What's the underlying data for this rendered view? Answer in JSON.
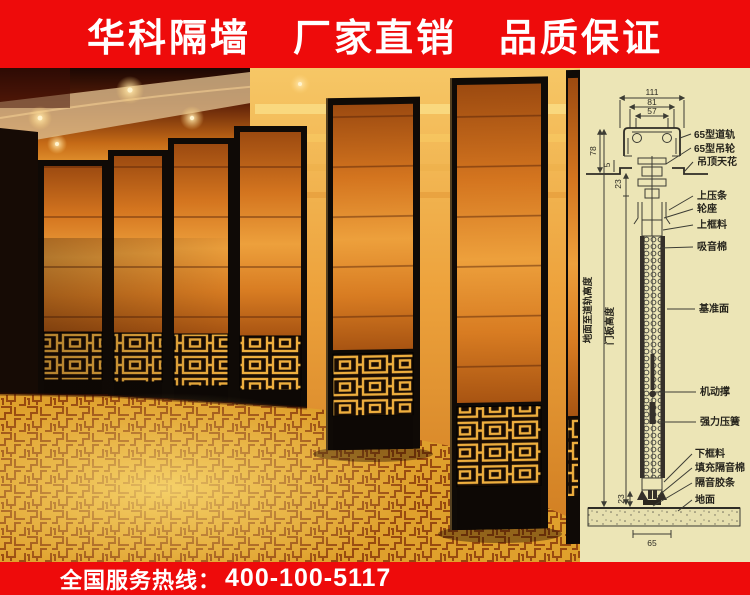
{
  "top_banner": {
    "segments": [
      "华科隔墙",
      "厂家直销",
      "品质保证"
    ]
  },
  "bottom_banner": {
    "hotline_label": "全国服务热线：",
    "phone": "400-100-5117"
  },
  "colors": {
    "banner_red": "#ee0b0b",
    "diagram_background": "#ece5b6",
    "photo_gold": "#dfa02c"
  },
  "diagram": {
    "dimensions": {
      "top_width": "111",
      "mid_width": "81",
      "inner_width": "57",
      "track_height": "78",
      "gap_small": "5",
      "top_offset": "23",
      "bottom_offset": "23",
      "bottom_width": "65"
    },
    "vertical_labels": {
      "floor_to_track": "地面至道轨高度",
      "panel_height": "门板高度"
    },
    "part_labels": [
      "65型道轨",
      "65型吊轮",
      "吊顶天花",
      "上压条",
      "轮座",
      "上框料",
      "吸音棉",
      "基准面",
      "机动撑",
      "强力压簧",
      "下框料",
      "填充隔音棉",
      "隔音胶条",
      "地面"
    ]
  }
}
